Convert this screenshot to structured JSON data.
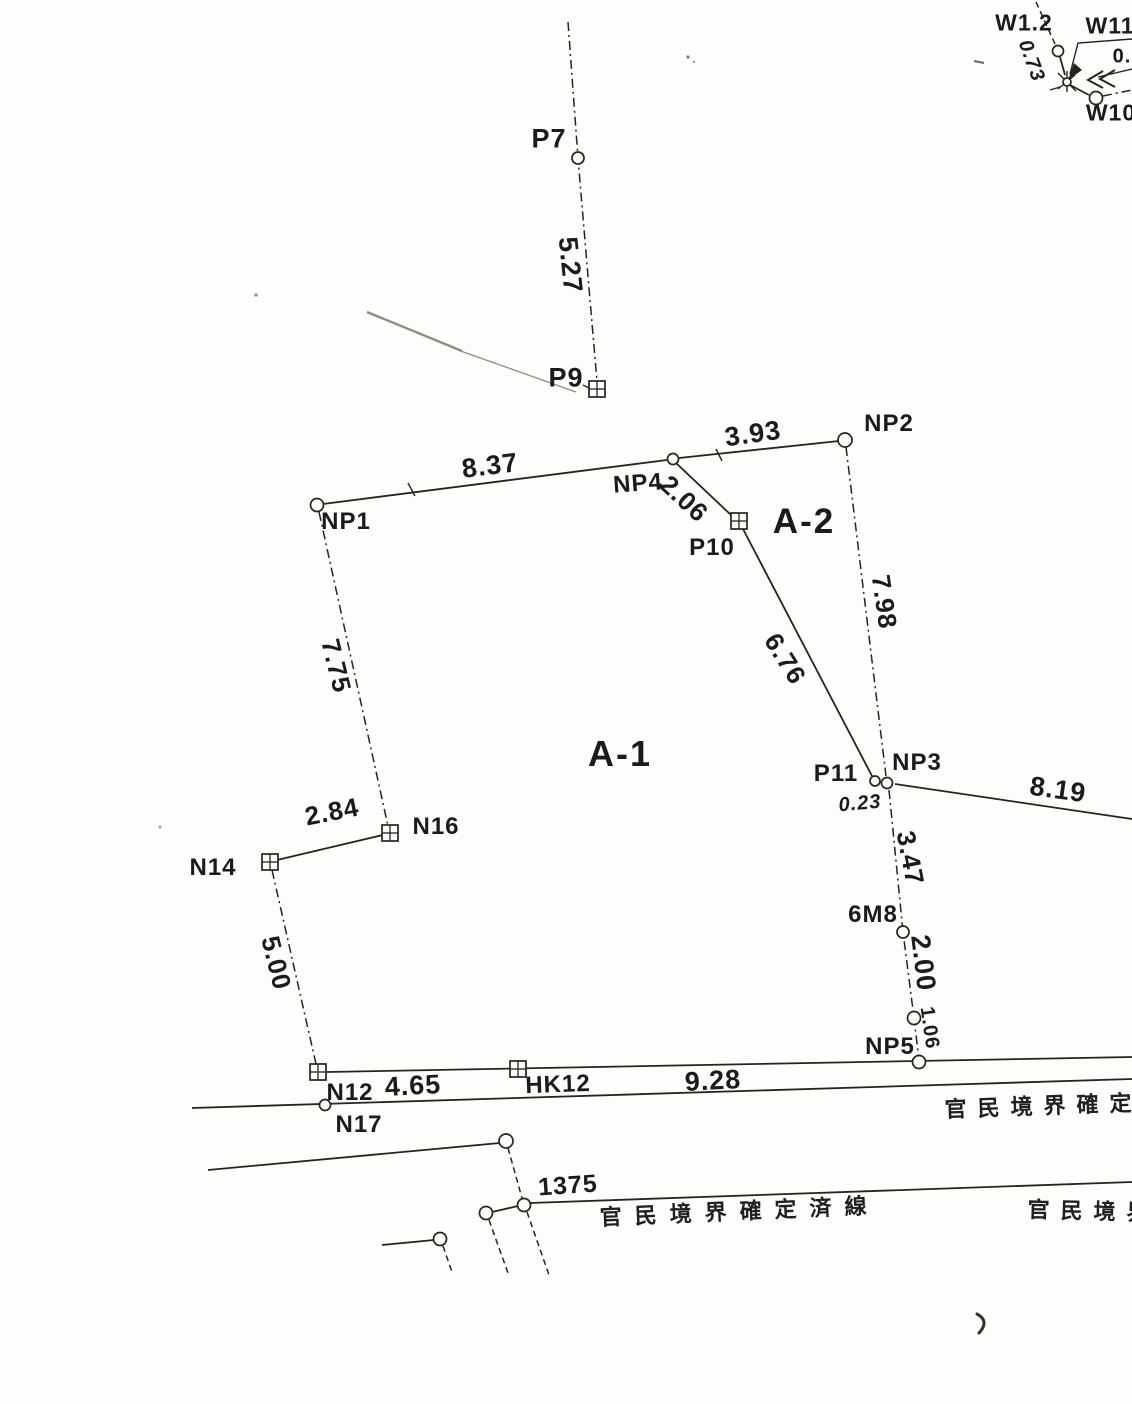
{
  "diagram": {
    "title": "cadastral boundary survey sketch",
    "parcels": {
      "a1": "A-1",
      "a2": "A-2"
    },
    "points": {
      "p7": "P7",
      "p9": "P9",
      "np1": "NP1",
      "np2": "NP2",
      "np3": "NP3",
      "np4": "NP4",
      "np5": "NP5",
      "p10": "P10",
      "p11": "P11",
      "n12": "N12",
      "n14": "N14",
      "n16": "N16",
      "n17": "N17",
      "hk12": "HK12",
      "m6m8": "6M8",
      "w12": "W1.2",
      "w11": "W11",
      "w10": "W10"
    },
    "distances": {
      "d527": "5.27",
      "d837": "8.37",
      "d393": "3.93",
      "d206": "2.06",
      "d798": "7.98",
      "d676": "6.76",
      "d775": "7.75",
      "d284": "2.84",
      "d500": "5.00",
      "d465": "4.65",
      "d928": "9.28",
      "d819": "8.19",
      "d347": "3.47",
      "d200": "2.00",
      "d106": "1.06",
      "d023": "0.23",
      "d073": "0.73",
      "d0": "0.",
      "d1375": "1375"
    },
    "notes": {
      "right": "官民境界確定",
      "center": "官民境界確定済線",
      "bottom_right": "官民境界"
    },
    "colors": {
      "ink": "#26241f",
      "paper": "#fdfdfc",
      "faint": "#8f8b85"
    }
  }
}
